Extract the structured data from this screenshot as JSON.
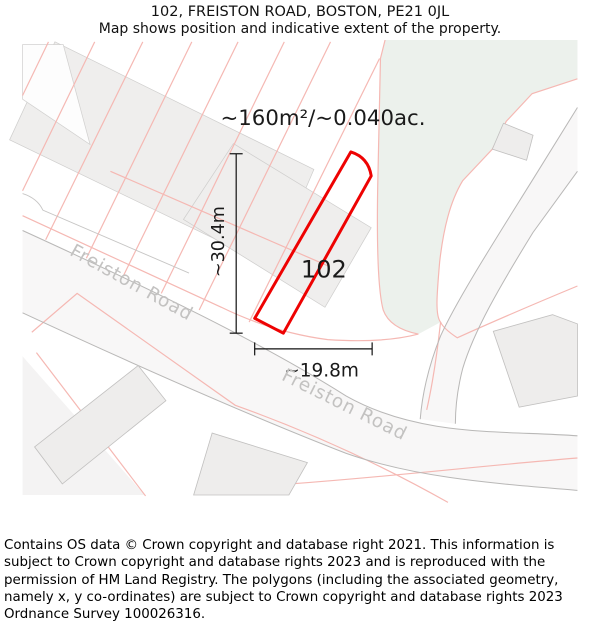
{
  "header": {
    "title": "102, FREISTON ROAD, BOSTON, PE21 0JL",
    "subtitle": "Map shows position and indicative extent of the property."
  },
  "map": {
    "area_label": "~160m²/~0.040ac.",
    "property_number": "102",
    "dim_vertical_label": "~30.4m",
    "dim_horizontal_label": "~19.8m",
    "road_name_1": "Freiston Road",
    "road_name_2": "Freiston Road",
    "colors": {
      "property_outline": "#ee0202",
      "parcel_line": "#f5b8b3",
      "green_area": "#ecf1ec",
      "building_fill": "#efeeed",
      "road_fill": "#f8f7f7",
      "road_edge": "#b9b8b7",
      "road_label_gray": "#c3c2c1"
    }
  },
  "footer": {
    "attribution": "Contains OS data © Crown copyright and database right 2021. This information is subject to Crown copyright and database rights 2023 and is reproduced with the permission of HM Land Registry. The polygons (including the associated geometry, namely x, y co-ordinates) are subject to Crown copyright and database rights 2023 Ordnance Survey 100026316."
  }
}
